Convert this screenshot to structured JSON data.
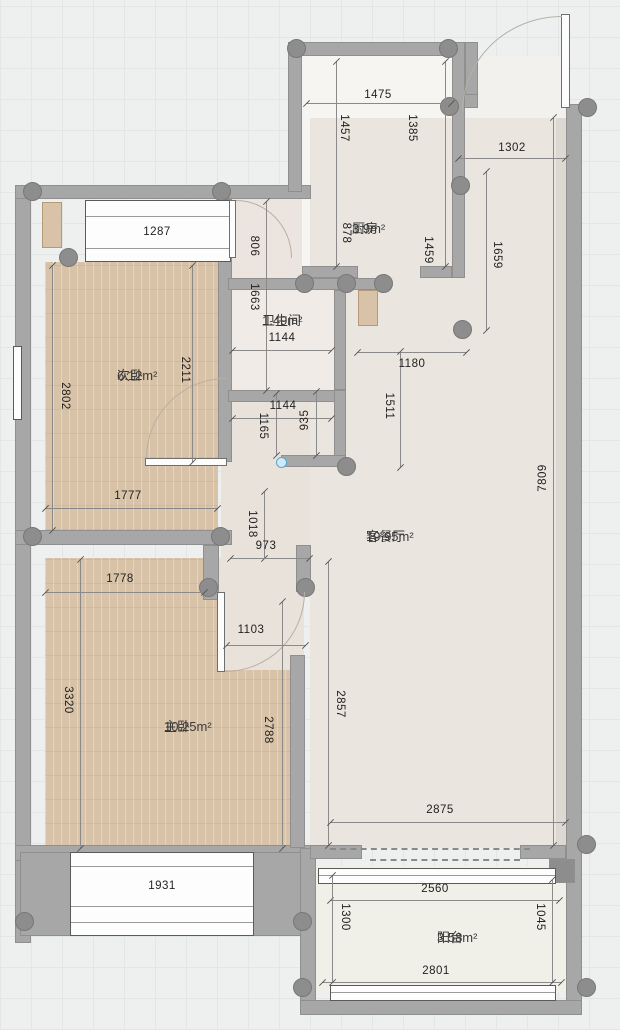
{
  "plan_title": "apartment-floor-plan",
  "rooms": {
    "kitchen": {
      "name": "厨房",
      "area": "3.9m²"
    },
    "bath": {
      "name": "卫生间",
      "area": "1.49m²"
    },
    "second_bedroom": {
      "name": "次卧",
      "area": "6.12m²"
    },
    "living": {
      "name": "客餐厅",
      "area": "19.95m²"
    },
    "master_bedroom": {
      "name": "主卧",
      "area": "10.25m²"
    },
    "balcony": {
      "name": "阳台",
      "area": "3.58m²"
    }
  },
  "dims": {
    "kitchen_width_top": "1475",
    "kitchen_left_upper": "1457",
    "kitchen_right_upper": "1385",
    "entry_width": "1302",
    "kitchen_left_lower": "878",
    "kitchen_right_lower": "1459",
    "entry_depth": "1659",
    "second_bedroom_window": "1287",
    "hall_upper": "806",
    "hall_lower": "1663",
    "bath_width_top": "1144",
    "second_bedroom_right": "2211",
    "second_bedroom_left": "2802",
    "living_top_width": "1180",
    "living_upper_height": "1511",
    "bath_width_bottom": "1144",
    "hall_right": "935",
    "hall_left": "1165",
    "living_right_height": "7809",
    "second_bedroom_width": "1777",
    "hall_bottom_height": "1018",
    "hall_bottom_width": "973",
    "master_top_width": "1778",
    "master_door_width": "1103",
    "master_left_height": "3320",
    "master_right_height": "2788",
    "living_lower_height": "2857",
    "living_bottom_width": "2875",
    "master_window": "1931",
    "balcony_left_height": "1300",
    "balcony_top_width": "2560",
    "balcony_bottom_width": "2801",
    "balcony_right_height": "1045"
  },
  "colors": {
    "wall": "#a7a7a7",
    "column": "#8d8d8d",
    "wood_floor": "#d9c3a8",
    "living_floor": "#eae5de",
    "kitchen_floor": "#f6f5f2",
    "door_stop_blue": "#cfeaf6"
  }
}
